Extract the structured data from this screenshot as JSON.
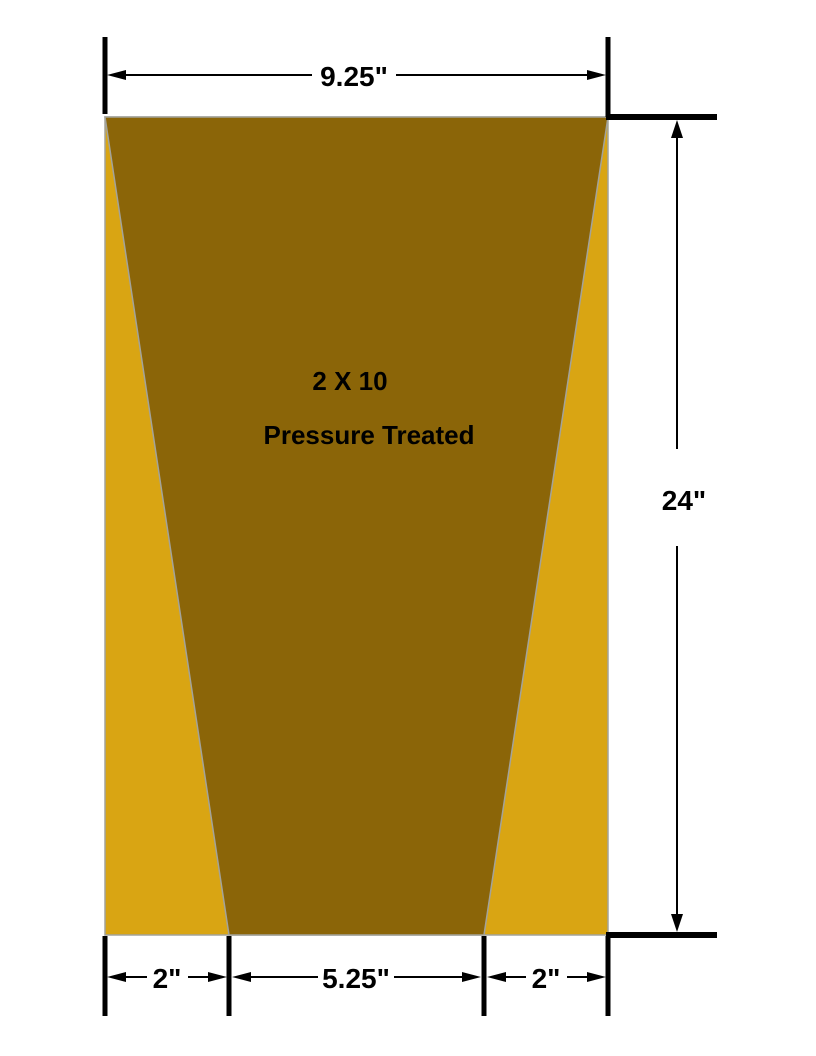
{
  "labels": {
    "size": "2 X 10",
    "treatment": "Pressure Treated"
  },
  "dimensions": {
    "top_width": "9.25\"",
    "height": "24\"",
    "bottom_left": "2\"",
    "bottom_center": "5.25\"",
    "bottom_right": "2\""
  },
  "colors": {
    "sapwood": "#D9A513",
    "heartwood": "#8B6508",
    "outline": "#A3A39B"
  }
}
